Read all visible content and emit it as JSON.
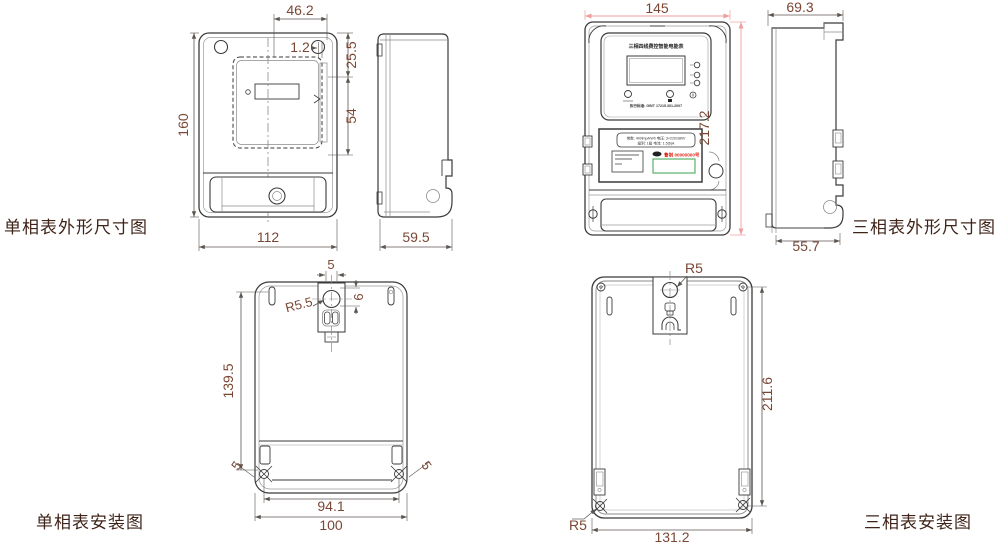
{
  "colors": {
    "outline": "#3a3a3a",
    "inner_line": "#8a8a8a",
    "dim_line": "#5b5550",
    "dim_text": "#7b4734",
    "accent_dim_line": "#ef9e9e",
    "caption_text": "#40241a",
    "serial_red": "#e02818",
    "barcode_green": "#56b46a"
  },
  "captions": {
    "single_outline": "单相表外形尺寸图",
    "three_outline": "三相表外形尺寸图",
    "single_install": "单相表安装图",
    "three_install": "三相表安装图"
  },
  "single_outline_dims": {
    "hole_span": "46.2",
    "lip": "1.2",
    "top_section": "25.5",
    "window": "54",
    "height": "160",
    "width": "112",
    "depth": "59.5"
  },
  "three_outline": {
    "dims": {
      "width": "145",
      "height": "217.2",
      "depth": "69.3",
      "terminal_depth": "55.7"
    },
    "faceplate": {
      "title": "三相四线费控智能电能表",
      "standard": "执行标准: GB/T 17215.301-2007"
    },
    "nameplate": {
      "spec_line1": "常数: 400imp/kWh  电压: 3×220/380V",
      "spec_line2": "级别: 1级  电流: 1.5(6)A",
      "serial": "鲁制 00000000号"
    }
  },
  "single_install_dims": {
    "slot_width": "5",
    "hole_offset": "6",
    "hole_radius": "R5.5",
    "height": "139.5",
    "ear_left": "5",
    "ear_right": "5",
    "hole_span": "94.1",
    "width": "100"
  },
  "three_install_dims": {
    "top_radius": "R5",
    "height": "211.6",
    "bottom_radius": "R5",
    "width": "131.2"
  }
}
